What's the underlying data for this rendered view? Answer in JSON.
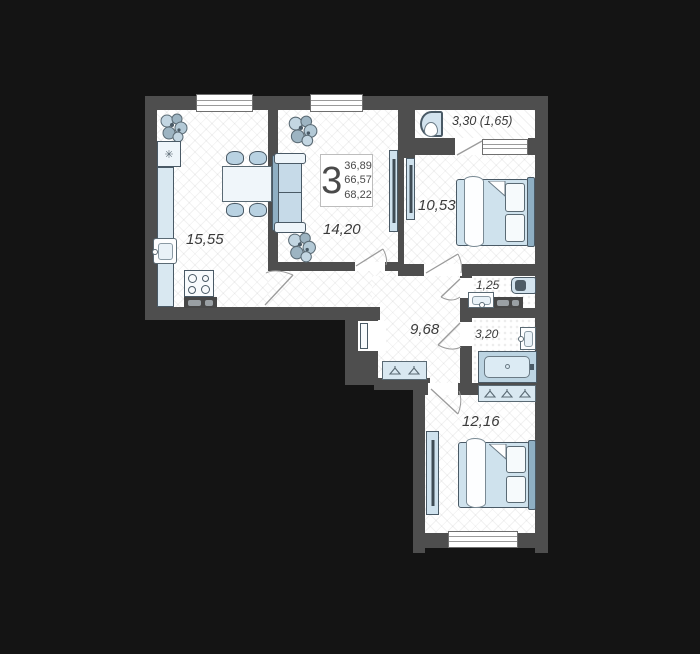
{
  "info": {
    "rooms_count": "3",
    "areas": [
      "36,89",
      "66,57",
      "68,22"
    ]
  },
  "rooms": {
    "kitchen": {
      "area": "15,55"
    },
    "living_room": {
      "area": "14,20"
    },
    "bedroom_top": {
      "area": "10,53"
    },
    "bedroom_bottom": {
      "area": "12,16"
    },
    "hallway": {
      "area": "9,68"
    },
    "toilet": {
      "area": "1,25"
    },
    "bathroom": {
      "area": "3,20"
    },
    "balcony": {
      "area": "3,30 (1,65)"
    }
  },
  "icons": {
    "fridge_glyph": "✳"
  },
  "colors": {
    "background": "#141414",
    "wall": "#4e4e4e",
    "floor": "#ffffff",
    "furniture_fill": "#d3e3ee",
    "furniture_accent": "#8fafc3",
    "outline": "#4a5a66",
    "label": "#3a3a3a"
  }
}
